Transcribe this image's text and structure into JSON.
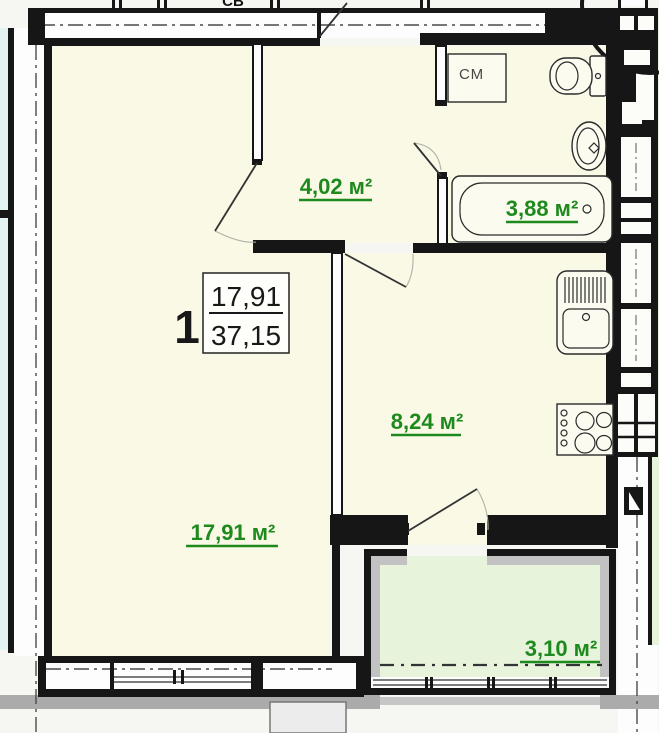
{
  "plan": {
    "kind": "apartment floor plan",
    "annotations": {
      "north_mark": "СВ",
      "washing_machine": "СМ"
    },
    "stamp": {
      "number": "1",
      "living_area": "17,91",
      "total_area": "37,15"
    },
    "rooms": {
      "hallway": {
        "area_label": "4,02 м²"
      },
      "bathroom": {
        "area_label": "3,88 м²"
      },
      "kitchen": {
        "area_label": "8,24 м²"
      },
      "living_room": {
        "area_label": "17,91 м²"
      },
      "balcony": {
        "area_label": "3,10 м²"
      }
    },
    "colors": {
      "wall": "#161616",
      "room_fill": "#faf9e6",
      "balcony_fill": "#e8f3dc",
      "outside_fill": "#e2f3f2",
      "area_label_green": "#1e8a1e",
      "shadow_gray": "#ababab"
    }
  }
}
